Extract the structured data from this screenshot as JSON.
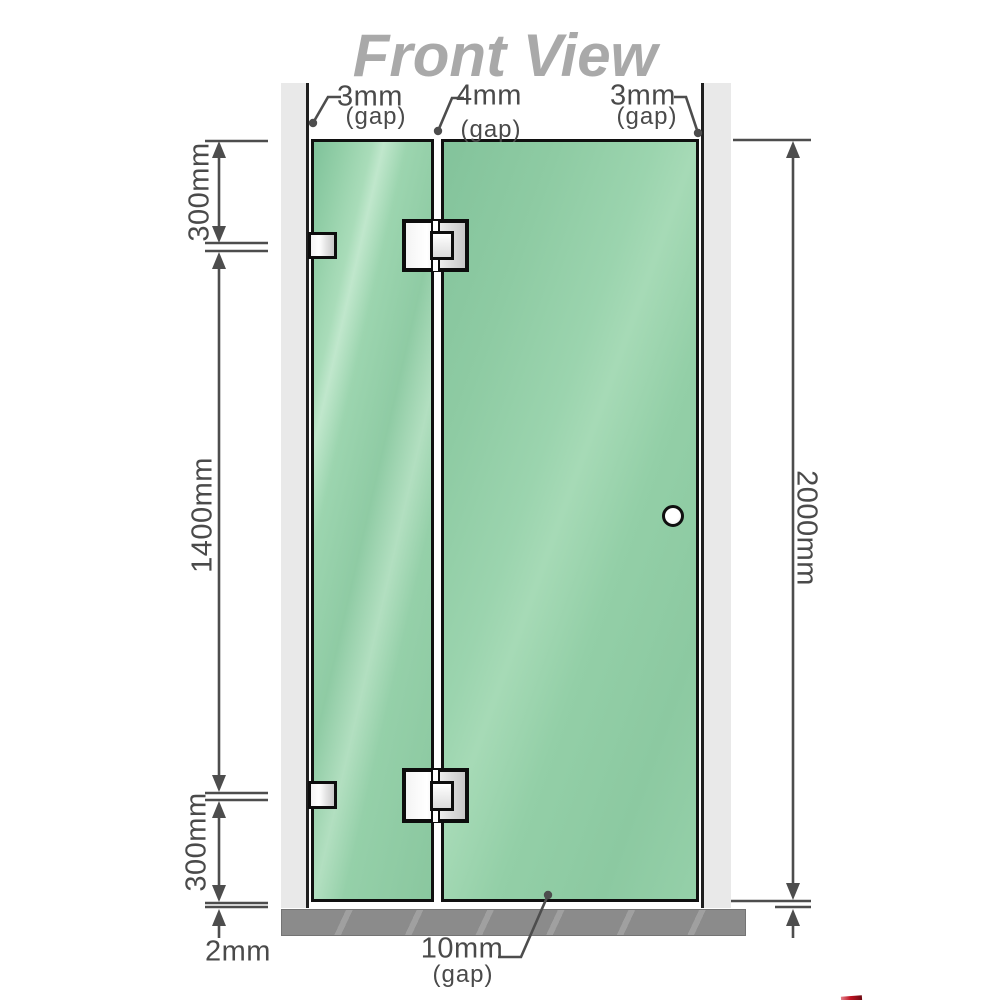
{
  "title": "Front View",
  "labels": {
    "gap_top_left": {
      "value": "3mm",
      "qualifier": "(gap)"
    },
    "gap_top_center": {
      "value": "4mm",
      "qualifier": "(gap)"
    },
    "gap_top_right": {
      "value": "3mm",
      "qualifier": "(gap)"
    },
    "left_segment_top": "300mm",
    "left_segment_middle": "1400mm",
    "left_segment_bottom": "300mm",
    "right_total_height": "2000mm",
    "bottom_floor_gap": "2mm",
    "bottom_door_gap": {
      "value": "10mm",
      "qualifier": "(gap)"
    }
  },
  "colors": {
    "glass_green": "#8fcba4",
    "glass_highlight": "#c0e7cc",
    "wall_gray": "#e9e9e9",
    "floor_gray": "#8b8b8b",
    "dimension_gray": "#4d4d4d",
    "title_gray": "#a9a9a9",
    "hardware_border": "#0d0d0d",
    "corner_accent_red": "#c01322"
  }
}
